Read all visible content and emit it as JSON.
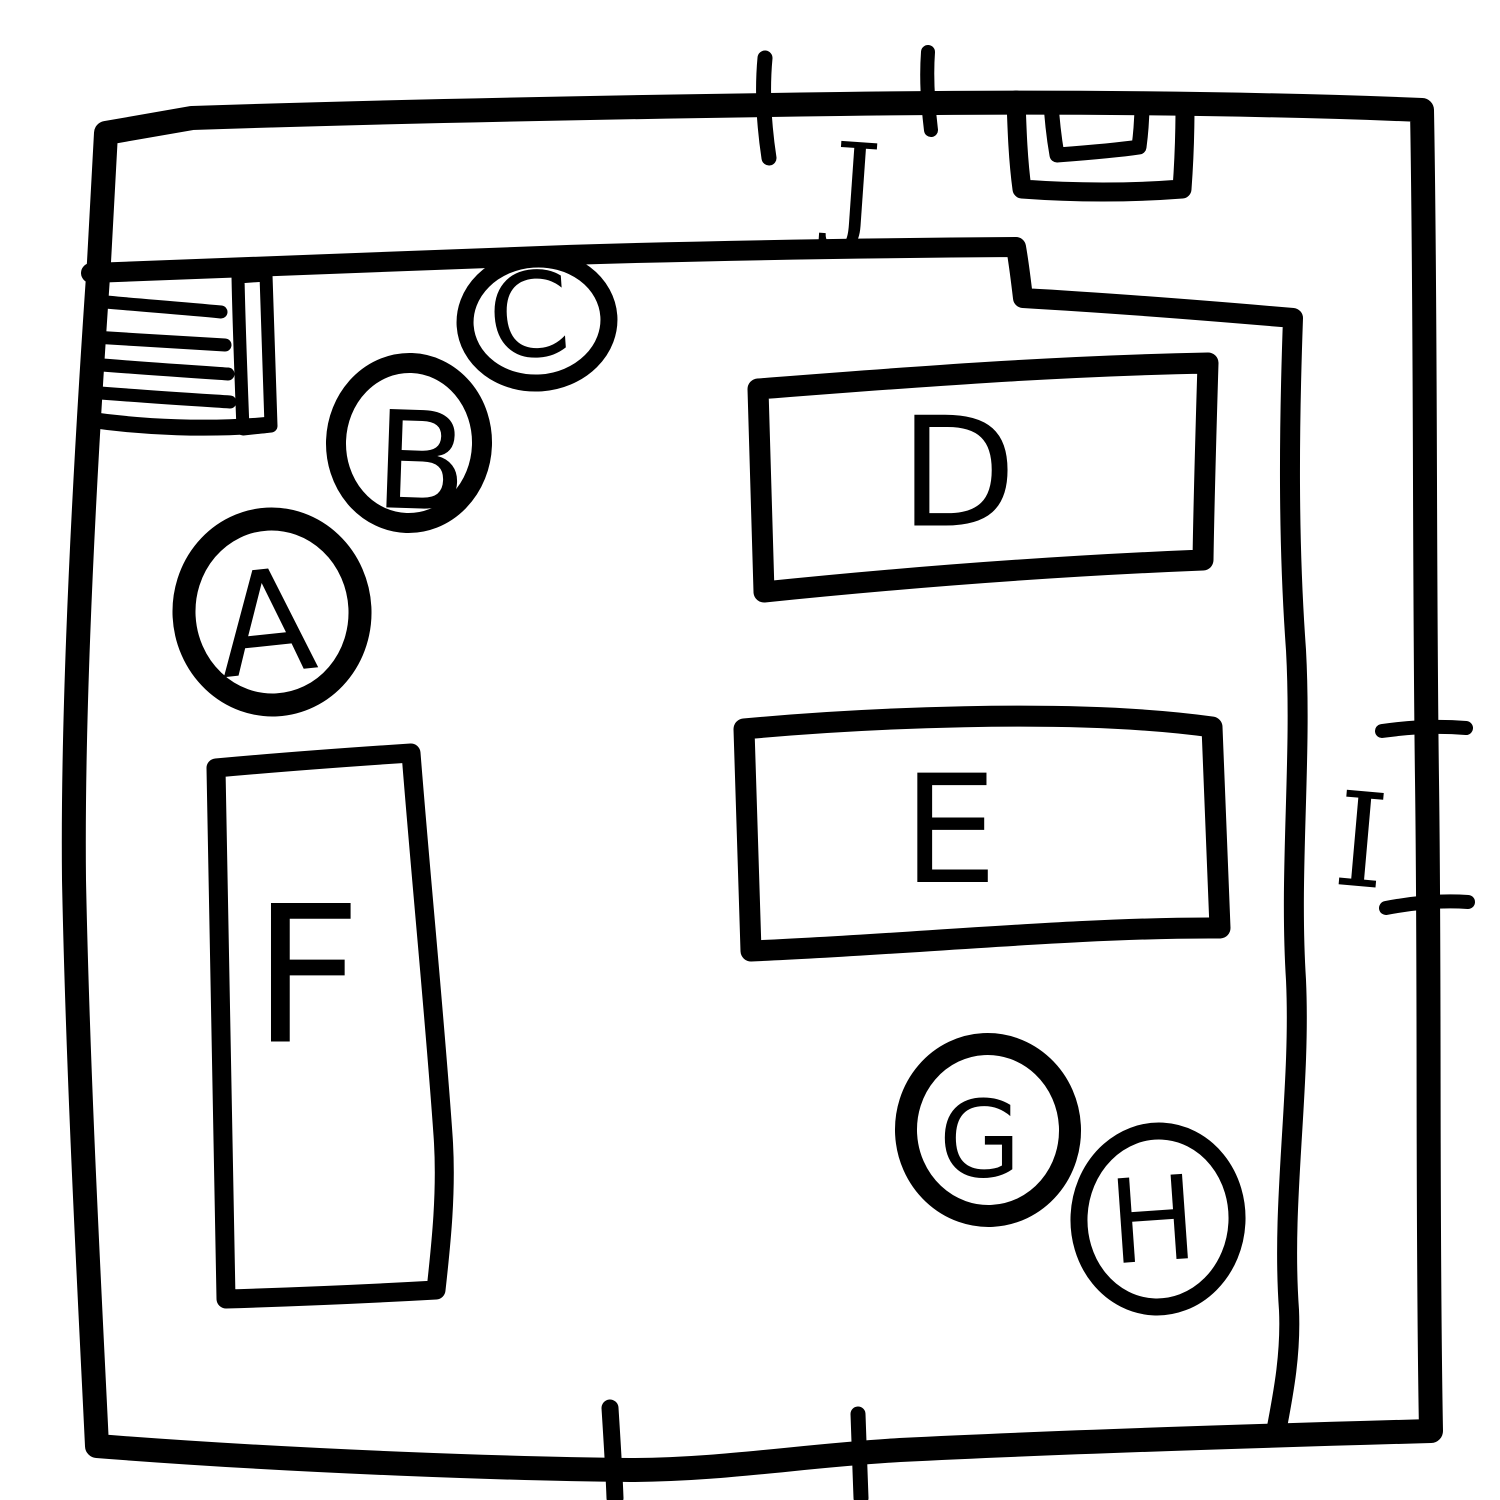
{
  "canvas": {
    "width": 1500,
    "height": 1500,
    "background_color": "#ffffff",
    "ink_color": "#000000"
  },
  "sketch": {
    "kind": "hand-drawn room plan",
    "labels": {
      "A": "A",
      "B": "B",
      "C": "C",
      "D": "D",
      "E": "E",
      "F": "F",
      "G": "G",
      "H": "H",
      "I": "I",
      "J": "J"
    }
  },
  "markers": {
    "circles": [
      {
        "label": "A",
        "cx": 272,
        "cy": 612,
        "rx": 88,
        "ry": 93,
        "label_x": 266,
        "label_y": 624,
        "font_size": 142
      },
      {
        "label": "B",
        "cx": 409,
        "cy": 443,
        "rx": 73,
        "ry": 80,
        "label_x": 421,
        "label_y": 462,
        "font_size": 135
      },
      {
        "label": "C",
        "cx": 537,
        "cy": 321,
        "rx": 72,
        "ry": 62,
        "label_x": 529,
        "label_y": 316,
        "font_size": 117
      },
      {
        "label": "G",
        "cx": 988,
        "cy": 1130,
        "rx": 82,
        "ry": 86,
        "label_x": 980,
        "label_y": 1140,
        "font_size": 106
      },
      {
        "label": "H",
        "cx": 1158,
        "cy": 1219,
        "rx": 79,
        "ry": 88,
        "label_x": 1153,
        "label_y": 1221,
        "font_size": 116
      }
    ],
    "zones": [
      {
        "label": "D",
        "x": 755,
        "y": 362,
        "width": 465,
        "height": 230,
        "label_x": 958,
        "label_y": 473,
        "font_size": 152
      },
      {
        "label": "E",
        "x": 744,
        "y": 710,
        "width": 476,
        "height": 241,
        "label_x": 950,
        "label_y": 831,
        "font_size": 150
      },
      {
        "label": "F",
        "x": 216,
        "y": 753,
        "width": 231,
        "height": 546,
        "label_x": 307,
        "label_y": 976,
        "font_size": 190
      }
    ],
    "openings": [
      {
        "label": "J",
        "side": "top",
        "tick_count": 2,
        "label_x": 856,
        "label_y": 187,
        "font_size": 118
      },
      {
        "label": "I",
        "side": "right",
        "tick_count": 2,
        "label_x": 1361,
        "label_y": 841,
        "font_size": 130
      },
      {
        "label": "",
        "side": "bottom",
        "tick_count": 2
      }
    ]
  },
  "features": {
    "stairs": {
      "position": "top-left",
      "hatch_lines": 4
    },
    "nested_squares": {
      "position": "top-right",
      "count": 2
    }
  }
}
